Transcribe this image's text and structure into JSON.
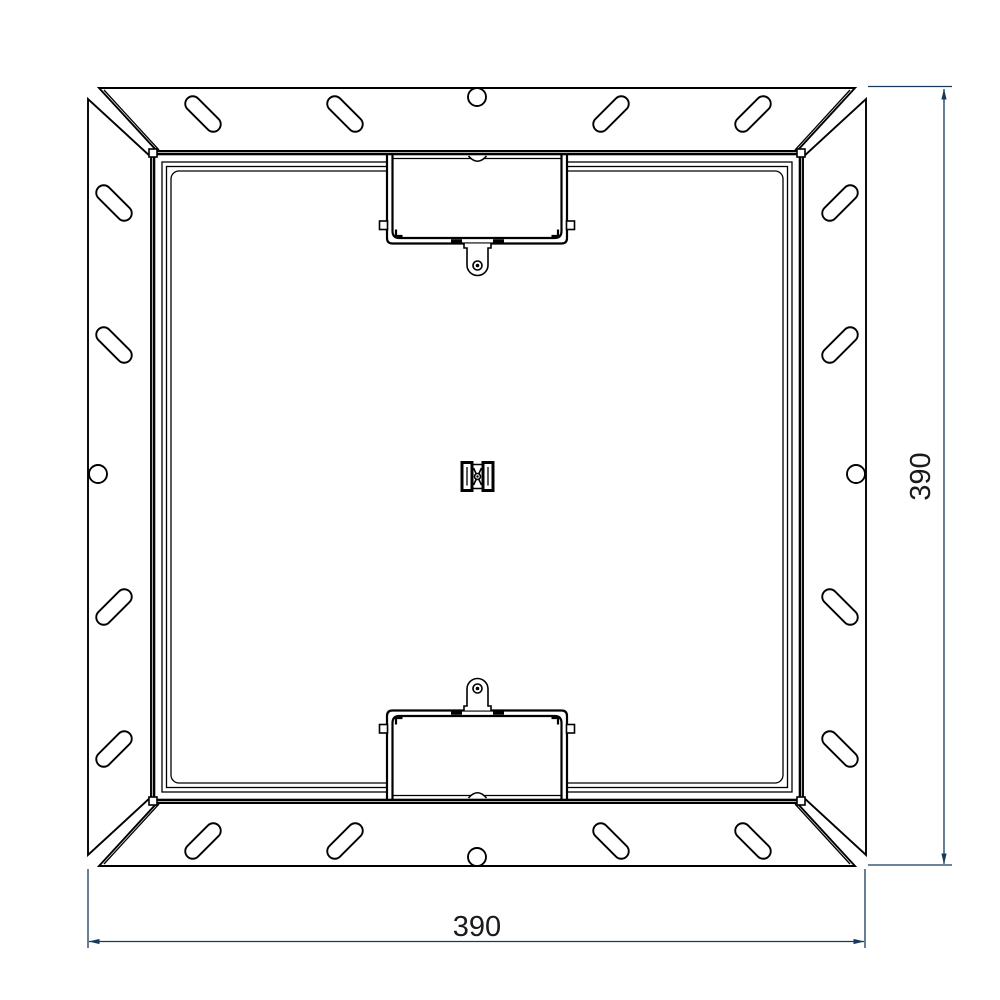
{
  "drawing": {
    "dimensions": {
      "width_label": "390",
      "height_label": "390"
    },
    "colors": {
      "line": "#000000",
      "dimension_line": "#173a5c",
      "dimension_text": "#1a1a1a",
      "background": "#ffffff"
    }
  }
}
